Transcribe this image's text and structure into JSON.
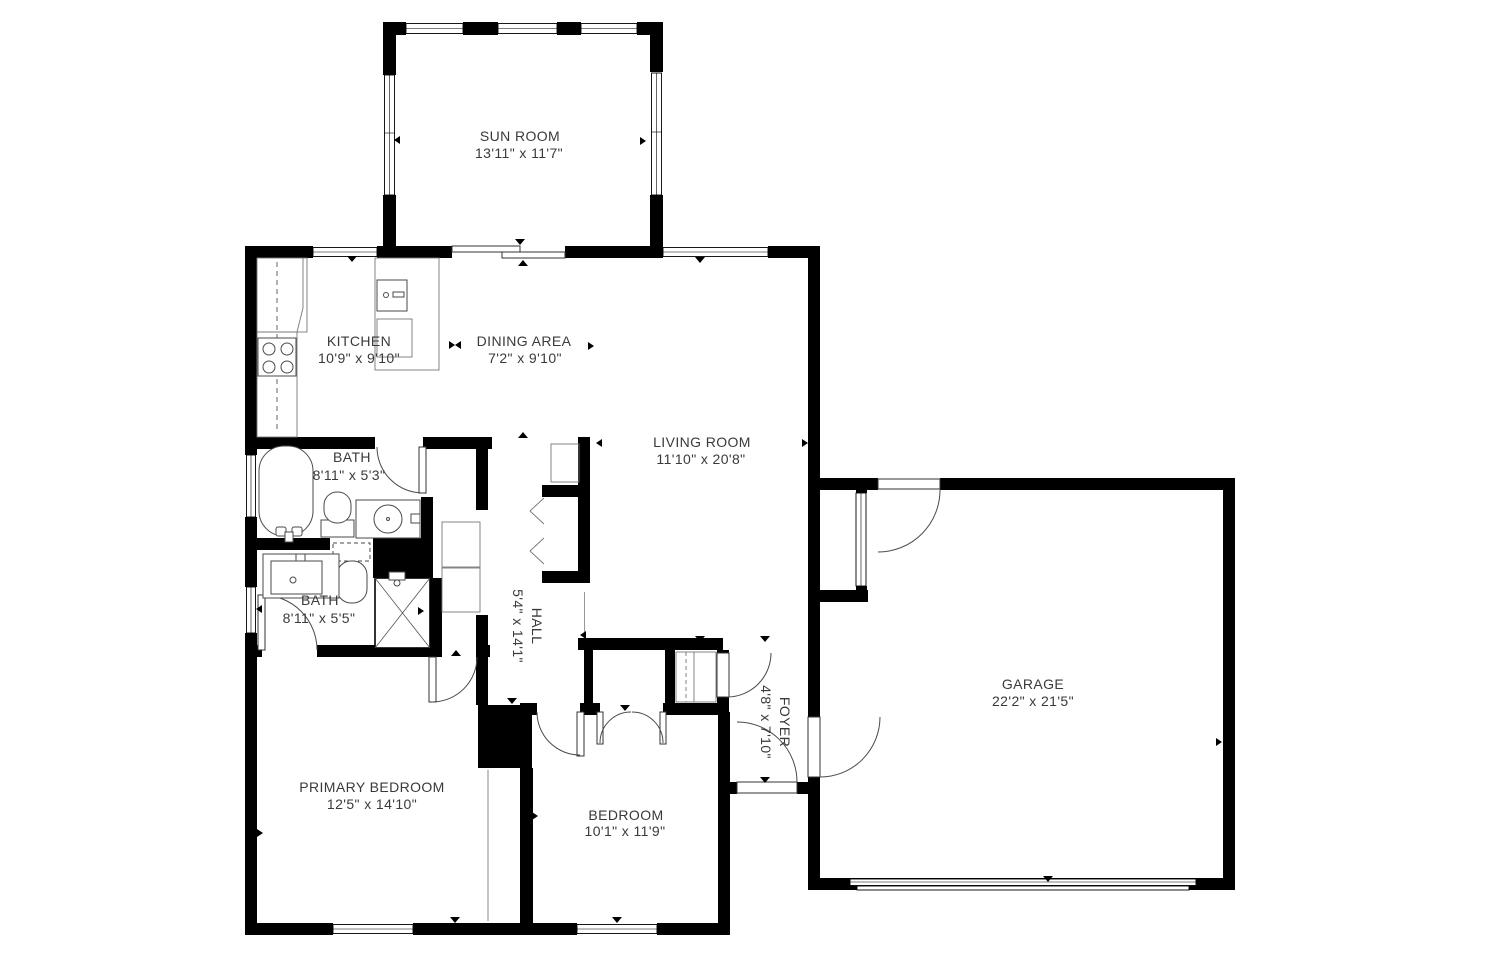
{
  "colors": {
    "wall": "#000000",
    "fixture": "#4a4a4a",
    "label": "#3a3a3a",
    "background": "#ffffff"
  },
  "rooms": [
    {
      "id": "sun-room",
      "name": "SUN ROOM",
      "dims": "13'11\" x 11'7\""
    },
    {
      "id": "kitchen",
      "name": "KITCHEN",
      "dims": "10'9\" x 9'10\""
    },
    {
      "id": "dining-area",
      "name": "DINING AREA",
      "dims": "7'2\" x 9'10\""
    },
    {
      "id": "living-room",
      "name": "LIVING ROOM",
      "dims": "11'10\" x 20'8\""
    },
    {
      "id": "bath-upper",
      "name": "BATH",
      "dims": "8'11\" x 5'3\""
    },
    {
      "id": "bath-lower",
      "name": "BATH",
      "dims": "8'11\" x 5'5\""
    },
    {
      "id": "hall",
      "name": "HALL",
      "dims": "5'4\" x 14'1\"",
      "rotated": true
    },
    {
      "id": "foyer",
      "name": "FOYER",
      "dims": "4'8\" x 7'10\"",
      "rotated": true
    },
    {
      "id": "garage",
      "name": "GARAGE",
      "dims": "22'2\" x 21'5\""
    },
    {
      "id": "primary-bedroom",
      "name": "PRIMARY BEDROOM",
      "dims": "12'5\" x 14'10\""
    },
    {
      "id": "bedroom",
      "name": "BEDROOM",
      "dims": "10'1\" x 11'9\""
    }
  ]
}
